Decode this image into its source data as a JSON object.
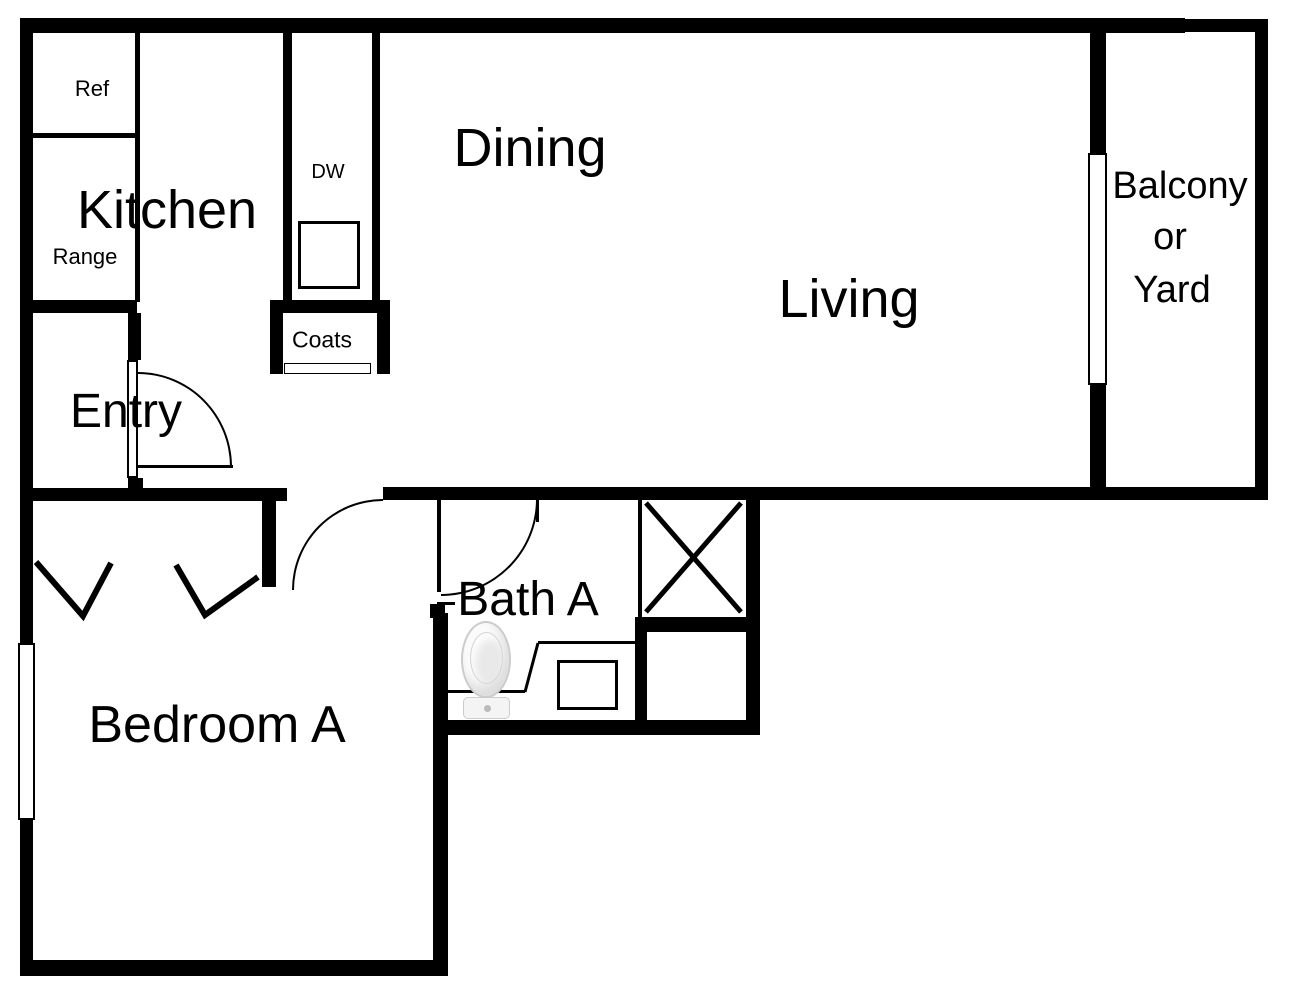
{
  "title": "Apartment unit floor plan",
  "rooms": {
    "kitchen": {
      "label": "Kitchen"
    },
    "dining": {
      "label": "Dining"
    },
    "living": {
      "label": "Living"
    },
    "balcony": {
      "line1": "Balcony",
      "line2": "or",
      "line3": "Yard"
    },
    "entry": {
      "label": "Entry"
    },
    "coats": {
      "label": "Coats"
    },
    "bath_a": {
      "label": "Bath A"
    },
    "bedroom_a": {
      "label": "Bedroom A"
    }
  },
  "fixtures": {
    "refrigerator": {
      "label": "Ref"
    },
    "range": {
      "label": "Range"
    },
    "dishwasher": {
      "label": "DW"
    }
  },
  "colors": {
    "wall": "#000000",
    "background": "#ffffff",
    "fixture_outline": "#cccccc"
  }
}
